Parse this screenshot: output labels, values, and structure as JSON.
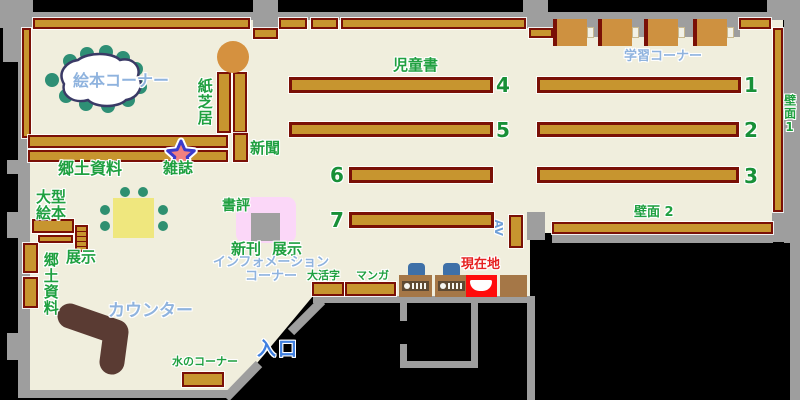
{
  "labels": {
    "ehon_corner": "絵本コーナー",
    "kamishibai": "紙芝居",
    "shinbun": "新聞",
    "zasshi": "雑誌",
    "kyodo_shiryo": "郷土資料",
    "ogata_ehon_line1": "大型",
    "ogata_ehon_line2": "絵本",
    "tenji_left": "展示",
    "kyodo_shiryo_left": "郷土資料",
    "jidosho": "児童書",
    "gakushu_corner": "学習コーナー",
    "hekimen1": "壁面1",
    "hekimen2": "壁面 2",
    "shohyo": "書評",
    "shinkan": "新刊",
    "tenji_right": "展示",
    "information_line1": "インフォメーション",
    "information_line2": "コーナー",
    "daikatsuji": "大活字",
    "manga": "マンガ",
    "genzaichi": "現在地",
    "counter": "カウンター",
    "mizu_corner": "水のコーナー",
    "iriguchi": "入口",
    "av": "AV"
  },
  "shelf_numbers": {
    "n1": "1",
    "n2": "2",
    "n3": "3",
    "n4": "4",
    "n5": "5",
    "n6": "6",
    "n7": "7"
  },
  "colors": {
    "outside": "#000000",
    "floor": "#F0EEDD",
    "wall": "#9E9E9E",
    "shelf_fill": "#C7952F",
    "shelf_border": "#7A1006",
    "label_green": "#1FA040",
    "label_blue": "#8FB3DE",
    "entrance_blue": "#4080E0",
    "current_location_red": "#FF0C0C",
    "counter_brown": "#5A3B33",
    "table_yellow": "#EFE77E",
    "seat_teal": "#2E8F75",
    "chair_blue": "#3E70A8",
    "desk_wood": "#CE9140",
    "display_pink": "#FBD7F8",
    "star_fill": "#F08080",
    "star_outline": "#3A3ACC"
  }
}
